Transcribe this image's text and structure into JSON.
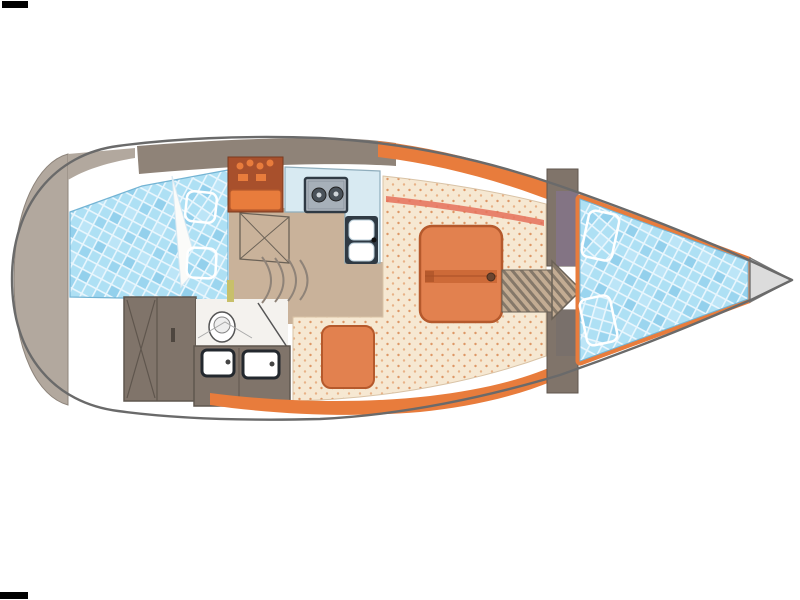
{
  "title": "Sailing yacht interior layout — top-view floor plan",
  "type": "floor-plan",
  "zones": [
    {
      "id": "stern-lazarette",
      "label": "Stern transom and lazarette locker"
    },
    {
      "id": "aft-cabin",
      "label": "Aft cabin double berth with two pillows"
    },
    {
      "id": "wardrobe",
      "label": "Aft wardrobe lockers with cross-braced doors"
    },
    {
      "id": "head",
      "label": "Head compartment with toilet and shower door"
    },
    {
      "id": "vanity",
      "label": "Vanity counter with twin washbasins"
    },
    {
      "id": "companionway",
      "label": "Companionway entry with steps and aft-cabin door"
    },
    {
      "id": "galley",
      "label": "L-shaped galley with two-burner stove and double sink"
    },
    {
      "id": "saloon",
      "label": "Saloon U-settee with folding table"
    },
    {
      "id": "settee-stool",
      "label": "Settee stool cushion"
    },
    {
      "id": "bow-cabin",
      "label": "Bow V-berth cabin with two pillows"
    },
    {
      "id": "anchor-locker",
      "label": "Bow tip anchor locker"
    }
  ],
  "colors": {
    "background": "#ffffff",
    "hull_line": "#6a6a6a",
    "deck_white": "#ffffff",
    "stern_block": "#b2a89e",
    "band_taupe": "#8f8378",
    "dark_taupe": "#80746a",
    "taupe_line": "#5f564e",
    "floor_tan": "#c9b29a",
    "cream": "#f6e8d2",
    "cream_dot": "#dd9766",
    "cream_dot2": "#e8b287",
    "salmon_stripe": "#e5705a",
    "orange": "#e2814f",
    "orange_dark": "#b5592c",
    "orange_trim": "#e87c3c",
    "cabinet_red": "#a8502c",
    "berth_blue": "#aee0f4",
    "berth_cell_a": "#93d0ec",
    "berth_cell_b": "#9bd5ef",
    "berth_cell_c": "#bce5f7",
    "berth_grid": "#e9f6fd",
    "berth_edge": "#74b4d4",
    "pillow_line": "#ffffff",
    "counter_blue": "#d8eaf2",
    "counter_line": "#90aebd",
    "stove_gray": "#b9c0c8",
    "stove_inner": "#a7b0b9",
    "burner": "#4a525a",
    "appliance_dark": "#2f3a44",
    "fixture_white": "#ffffff",
    "head_floor": "#f4f2ee",
    "fixture_line": "#555555",
    "hatch_base": "#c3ac93",
    "hatch_line": "#857869",
    "bulkhead_tint": "#837484",
    "foredeck_gray": "#dcdcdc",
    "black_bar": "#000000"
  }
}
